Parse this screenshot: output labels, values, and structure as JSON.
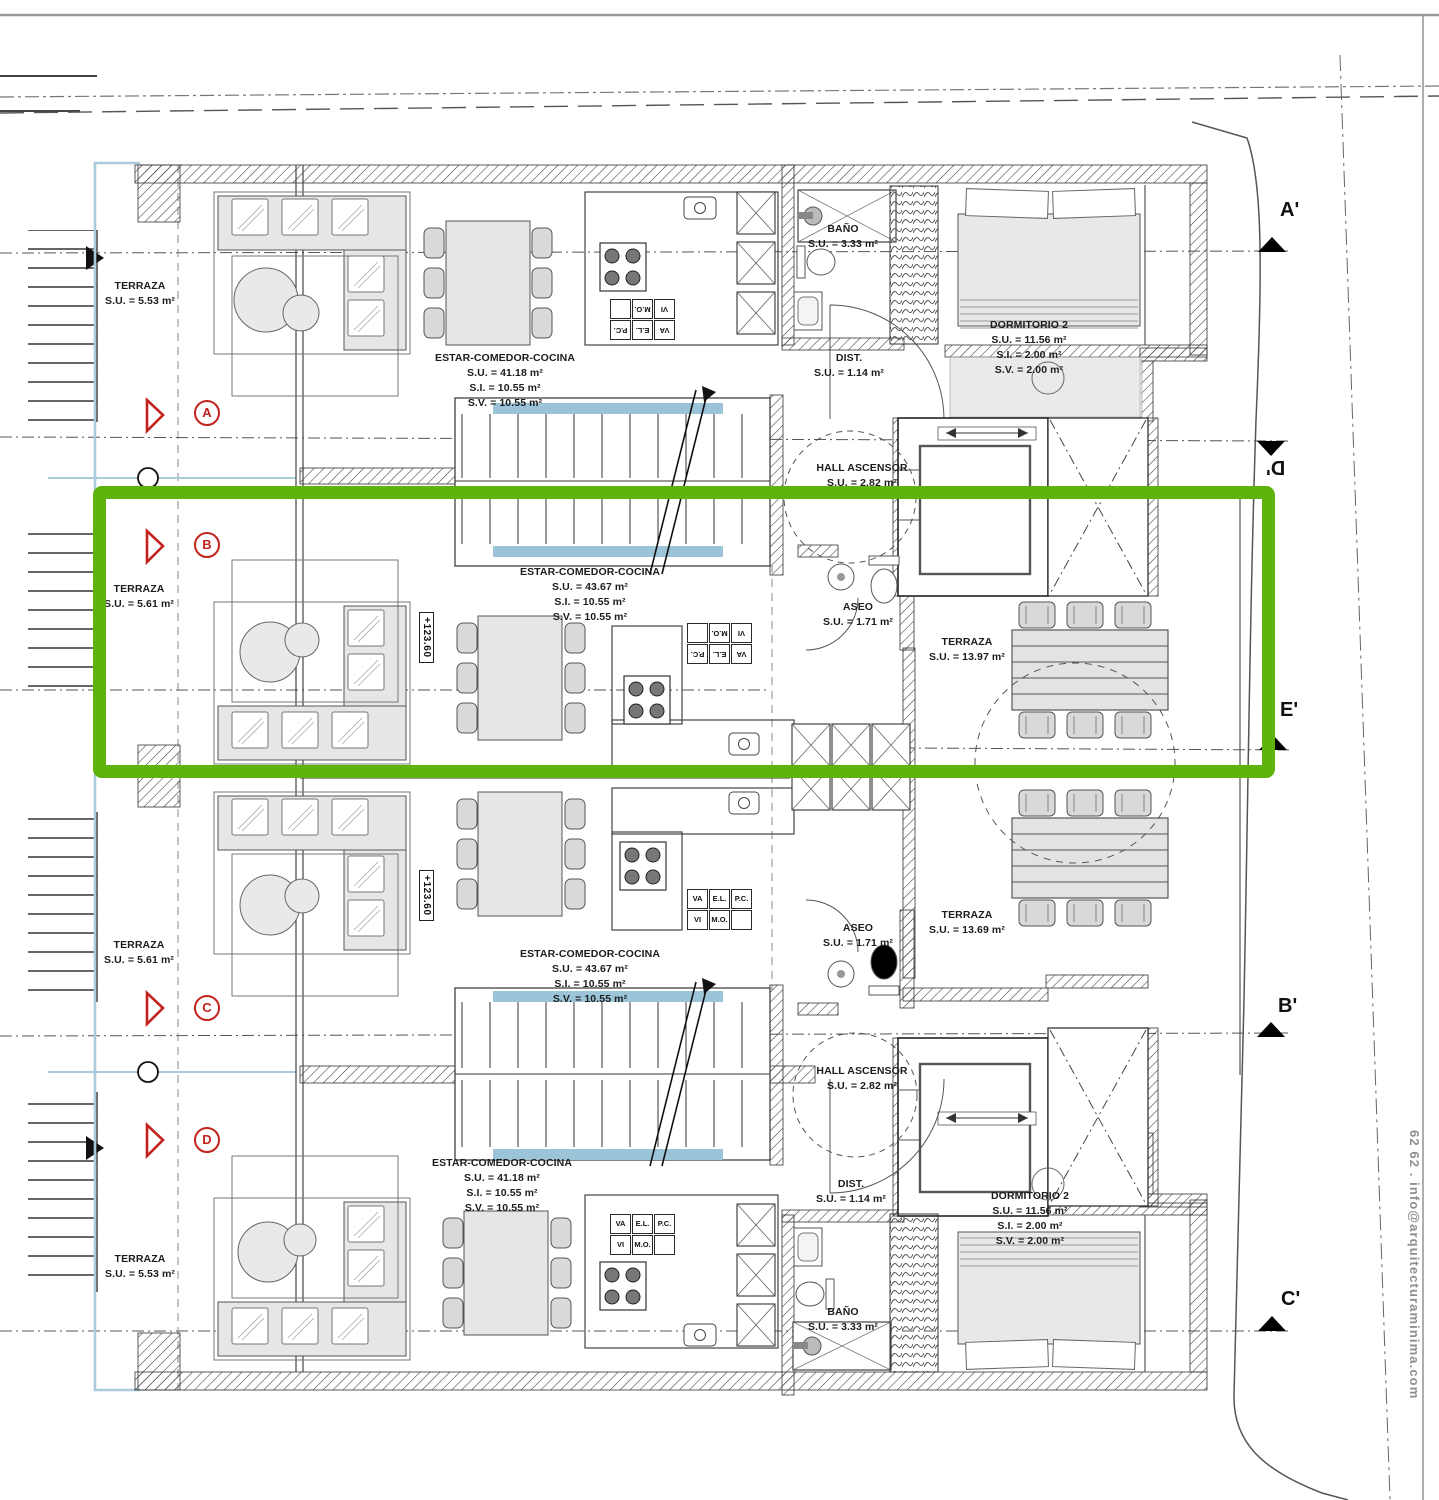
{
  "units": {
    "a": {
      "letter": "A",
      "terraza": {
        "name": "TERRAZA",
        "su": "S.U. = 5.53 m²"
      },
      "estar": {
        "name": "ESTAR-COMEDOR-COCINA",
        "su": "S.U. = 41.18 m²",
        "si": "S.I. = 10.55 m²",
        "sv": "S.V. = 10.55 m²"
      },
      "bano": {
        "name": "BAÑO",
        "su": "S.U. = 3.33 m²"
      },
      "dist": {
        "name": "DIST.",
        "su": "S.U. = 1.14 m²"
      },
      "dormitorio": {
        "name": "DORMITORIO 2",
        "su": "S.U. = 11.56 m²",
        "si": "S.I. = 2.00 m²",
        "sv": "S.V. = 2.00 m²"
      },
      "hall": {
        "name": "HALL ASCENSOR",
        "su": "S.U. = 2.82 m²"
      }
    },
    "b": {
      "letter": "B",
      "level": "+123.60",
      "terraza": {
        "name": "TERRAZA",
        "su": "S.U. = 5.61 m²"
      },
      "estar": {
        "name": "ESTAR-COMEDOR-COCINA",
        "su": "S.U. = 43.67 m²",
        "si": "S.I. = 10.55 m²",
        "sv": "S.V. = 10.55 m²"
      },
      "aseo": {
        "name": "ASEO",
        "su": "S.U. = 1.71 m²"
      },
      "terraza_ext": {
        "name": "TERRAZA",
        "su": "S.U. = 13.97 m²"
      }
    },
    "c": {
      "letter": "C",
      "level": "+123.60",
      "terraza": {
        "name": "TERRAZA",
        "su": "S.U. = 5.61 m²"
      },
      "estar": {
        "name": "ESTAR-COMEDOR-COCINA",
        "su": "S.U. = 43.67 m²",
        "si": "S.I. = 10.55 m²",
        "sv": "S.V. = 10.55 m²"
      },
      "aseo": {
        "name": "ASEO",
        "su": "S.U. = 1.71 m²"
      },
      "terraza_ext": {
        "name": "TERRAZA",
        "su": "S.U. = 13.69 m²"
      },
      "hall": {
        "name": "HALL ASCENSOR",
        "su": "S.U. = 2.82 m²"
      }
    },
    "d": {
      "letter": "D",
      "terraza": {
        "name": "TERRAZA",
        "su": "S.U. = 5.53 m²"
      },
      "estar": {
        "name": "ESTAR-COMEDOR-COCINA",
        "su": "S.U. = 41.18 m²",
        "si": "S.I. = 10.55 m²",
        "sv": "S.V. = 10.55 m²"
      },
      "dist": {
        "name": "DIST.",
        "su": "S.U. = 1.14 m²"
      },
      "dormitorio": {
        "name": "DORMITORIO 2",
        "su": "S.U. = 11.56 m²",
        "si": "S.I. = 2.00 m²",
        "sv": "S.V. = 2.00 m²"
      },
      "bano": {
        "name": "BAÑO",
        "su": "S.U. = 3.33 m²"
      }
    }
  },
  "sections": {
    "a_prime": "A'",
    "d_prime": "D'",
    "e_prime": "E'",
    "b_prime": "B'",
    "c_prime": "C'"
  },
  "kitchen_codes": {
    "va": "VA",
    "el": "E.L.",
    "pc": "P.C.",
    "vi": "VI",
    "mo": "M.O.",
    "empty": ""
  },
  "watermark": "62 62 . info@arquitecturaminima.com",
  "colors": {
    "highlight_green": "#5eb30d",
    "marker_red": "#c4221c",
    "stair_blue": "#9cc4d8",
    "terrace_blue": "#a9cbdc"
  }
}
